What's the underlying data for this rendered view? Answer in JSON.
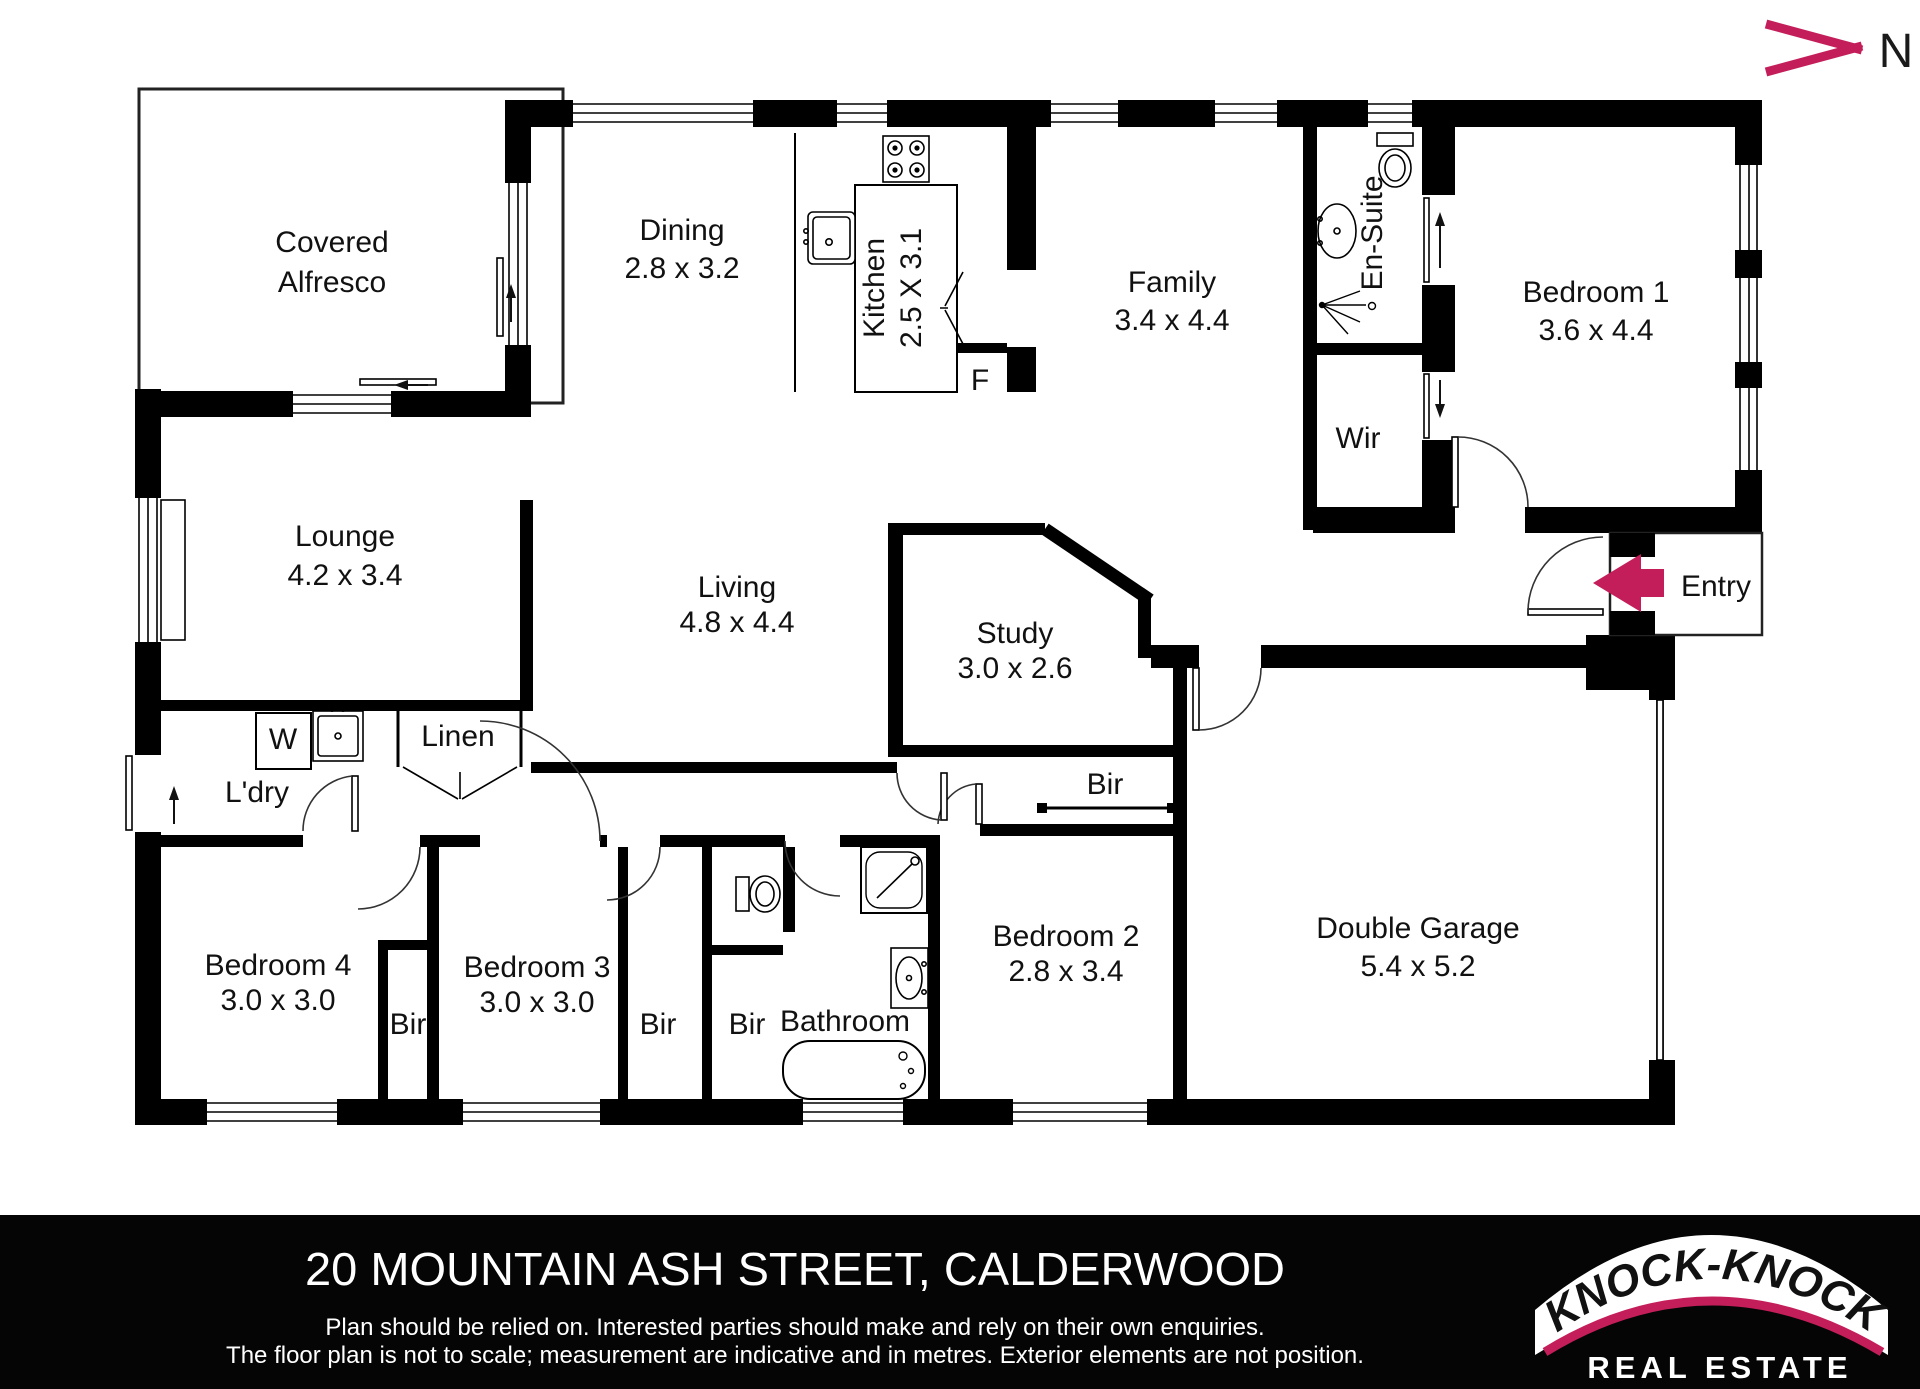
{
  "north": {
    "label": "N"
  },
  "rooms": {
    "alfresco": {
      "name": "Covered",
      "name2": "Alfresco"
    },
    "dining": {
      "name": "Dining",
      "dims": "2.8 x 3.2"
    },
    "kitchen": {
      "name": "Kitchen",
      "dims": "2.5 X 3.1"
    },
    "family": {
      "name": "Family",
      "dims": "3.4 x 4.4"
    },
    "ensuite": {
      "name": "En-Suite"
    },
    "bedroom1": {
      "name": "Bedroom 1",
      "dims": "3.6 x 4.4"
    },
    "wir": {
      "name": "Wir"
    },
    "entry": {
      "name": "Entry"
    },
    "lounge": {
      "name": "Lounge",
      "dims": "4.2 x 3.4"
    },
    "living": {
      "name": "Living",
      "dims": "4.8 x 4.4"
    },
    "study": {
      "name": "Study",
      "dims": "3.0 x 2.6"
    },
    "laundry": {
      "name": "L'dry"
    },
    "linen": {
      "name": "Linen"
    },
    "washer": {
      "name": "W"
    },
    "fridge": {
      "name": "F"
    },
    "garage": {
      "name": "Double Garage",
      "dims": "5.4 x 5.2"
    },
    "bedroom4": {
      "name": "Bedroom 4",
      "dims": "3.0 x 3.0"
    },
    "bedroom3": {
      "name": "Bedroom 3",
      "dims": "3.0 x 3.0"
    },
    "bedroom2": {
      "name": "Bedroom 2",
      "dims": "2.8 x 3.4"
    },
    "bathroom": {
      "name": "Bathroom"
    },
    "bir_study": {
      "name": "Bir"
    },
    "bir_bed4": {
      "name": "Bir"
    },
    "bir_bed3": {
      "name": "Bir"
    },
    "bir_bath": {
      "name": "Bir"
    }
  },
  "footer": {
    "address": "20 MOUNTAIN ASH STREET, CALDERWOOD",
    "disclaimer1": "Plan should be relied on. Interested parties should make and rely on their own enquiries.",
    "disclaimer2": "The floor plan is not to scale; measurement are indicative and in metres. Exterior elements are not position."
  },
  "logo": {
    "brand": "“KNOCK-KNOCK”",
    "tagline": "REAL ESTATE"
  },
  "colors": {
    "accent": "#C41E5A",
    "wall": "#000000",
    "background": "#FFFFFF"
  }
}
